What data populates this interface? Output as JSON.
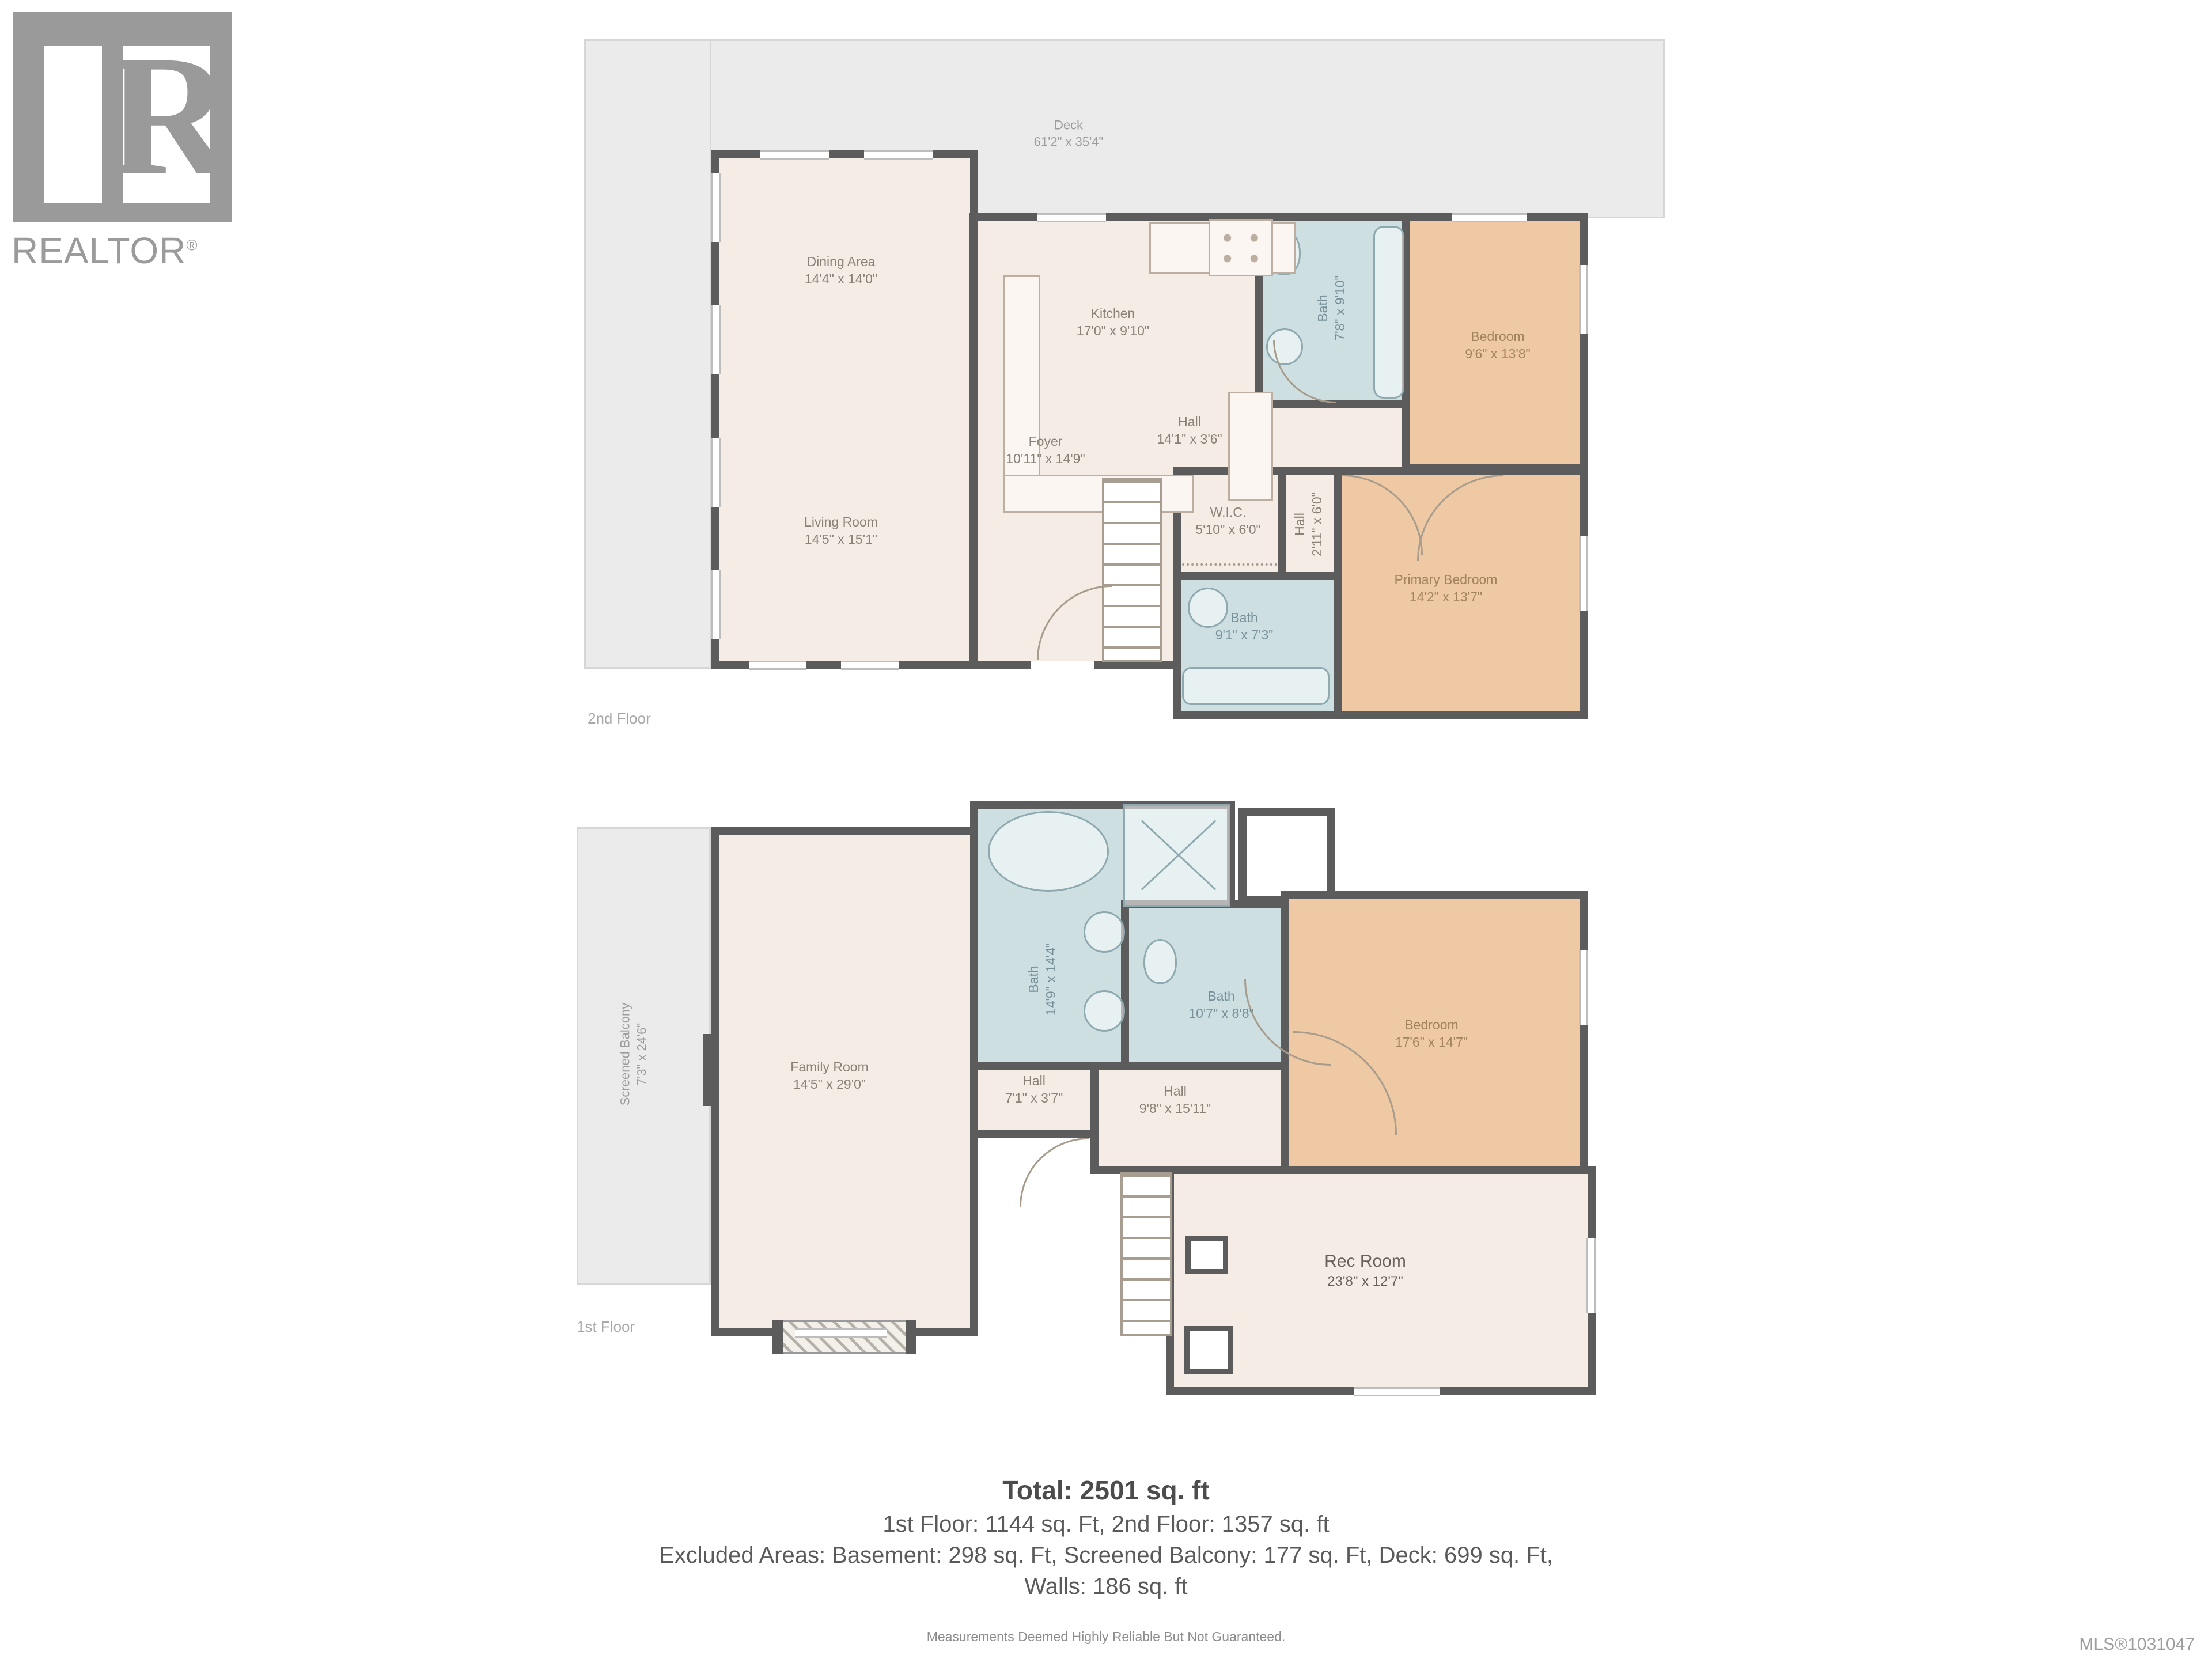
{
  "logo": {
    "brand": "REALTOR",
    "registered": "®",
    "mark_letter": "R"
  },
  "colors": {
    "wall": "#5c5c5c",
    "room_cream": "#f5ece6",
    "bedroom_tan": "#efc8a4",
    "bath_blue": "#cddfe1",
    "outdoor_gray": "#ebebeb"
  },
  "floors": [
    {
      "caption": "2nd Floor",
      "rooms": [
        {
          "label": "Deck",
          "dims": "61'2\" x 35'4\""
        },
        {
          "label": "Dining Area",
          "dims": "14'4\" x 14'0\""
        },
        {
          "label": "Kitchen",
          "dims": "17'0\" x 9'10\""
        },
        {
          "label": "Bath",
          "dims": "7'8\" x 9'10\""
        },
        {
          "label": "Bedroom",
          "dims": "9'6\" x 13'8\""
        },
        {
          "label": "Hall",
          "dims": "14'1\" x 3'6\""
        },
        {
          "label": "Foyer",
          "dims": "10'11\" x 14'9\""
        },
        {
          "label": "W.I.C.",
          "dims": "5'10\" x 6'0\""
        },
        {
          "label": "Hall",
          "dims": "2'11\" x 6'0\""
        },
        {
          "label": "Living Room",
          "dims": "14'5\" x 15'1\""
        },
        {
          "label": "Bath",
          "dims": "9'1\" x 7'3\""
        },
        {
          "label": "Primary Bedroom",
          "dims": "14'2\" x 13'7\""
        }
      ]
    },
    {
      "caption": "1st Floor",
      "rooms": [
        {
          "label": "Screened Balcony",
          "dims": "7'3\" x 24'6\""
        },
        {
          "label": "Family Room",
          "dims": "14'5\" x 29'0\""
        },
        {
          "label": "Bath",
          "dims": "14'9\" x 14'4\""
        },
        {
          "label": "Bath",
          "dims": "10'7\" x 8'8\""
        },
        {
          "label": "Bedroom",
          "dims": "17'6\" x 14'7\""
        },
        {
          "label": "Hall",
          "dims": "7'1\" x 3'7\""
        },
        {
          "label": "Hall",
          "dims": "9'8\" x 15'11\""
        },
        {
          "label": "Rec Room",
          "dims": "23'8\" x 12'7\""
        }
      ]
    }
  ],
  "summary": {
    "total": "Total: 2501 sq. ft",
    "line1": "1st Floor: 1144 sq. Ft, 2nd Floor: 1357 sq. ft",
    "line2": "Excluded Areas: Basement: 298 sq. Ft, Screened Balcony: 177 sq. Ft, Deck: 699 sq. Ft,",
    "line3": "Walls: 186 sq. ft"
  },
  "disclaimer": "Measurements Deemed Highly Reliable But Not Guaranteed.",
  "mls": "MLS®1031047"
}
